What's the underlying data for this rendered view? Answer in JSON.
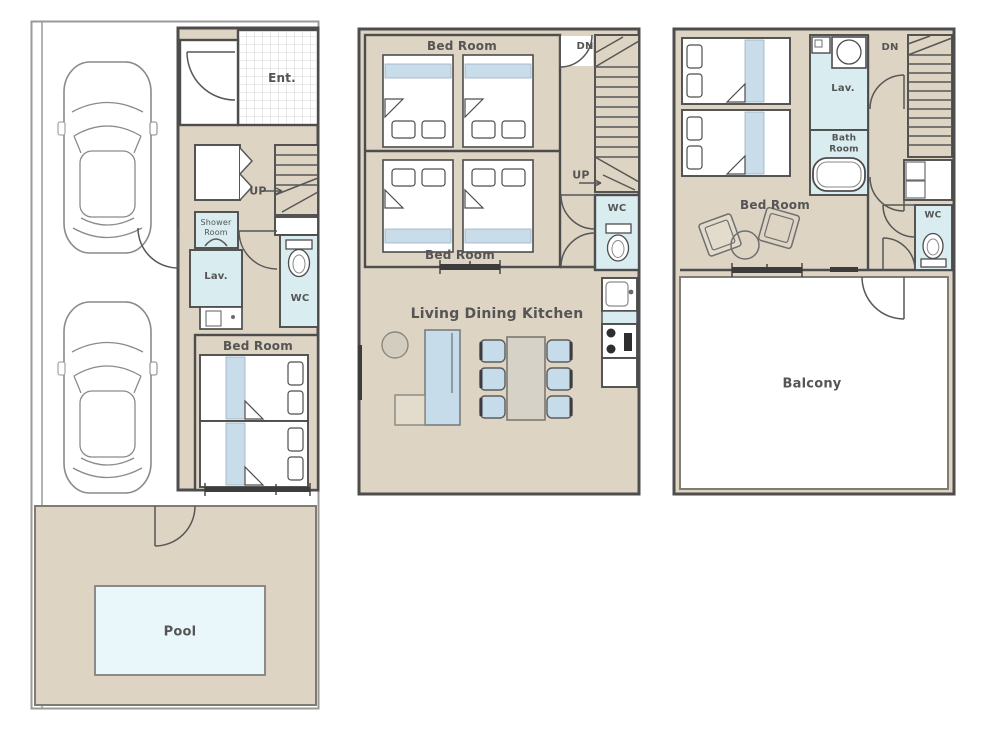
{
  "plan": {
    "colors": {
      "floor_tan": "#ded4c3",
      "wet_room_blue": "#d9ecf0",
      "pool_water": "#e9f7fb",
      "furniture_blue": "#c6dcea",
      "wall_dark": "#4d4d4d",
      "label_text": "#555555",
      "table_gray": "#d6d2c8"
    },
    "floor1": {
      "ent": "Ent.",
      "up": "UP",
      "shower_line1": "Shower",
      "shower_line2": "Room",
      "lav": "Lav.",
      "wc": "WC",
      "bed_room": "Bed Room",
      "pool": "Pool"
    },
    "floor2": {
      "bed_room_top": "Bed Room",
      "bed_room_bottom": "Bed Room",
      "dn": "DN",
      "up": "UP",
      "wc": "WC",
      "living": "Living Dining Kitchen"
    },
    "floor3": {
      "bed_room": "Bed Room",
      "lav": "Lav.",
      "bath_line1": "Bath",
      "bath_line2": "Room",
      "dn": "DN",
      "wc": "WC",
      "balcony": "Balcony"
    }
  }
}
